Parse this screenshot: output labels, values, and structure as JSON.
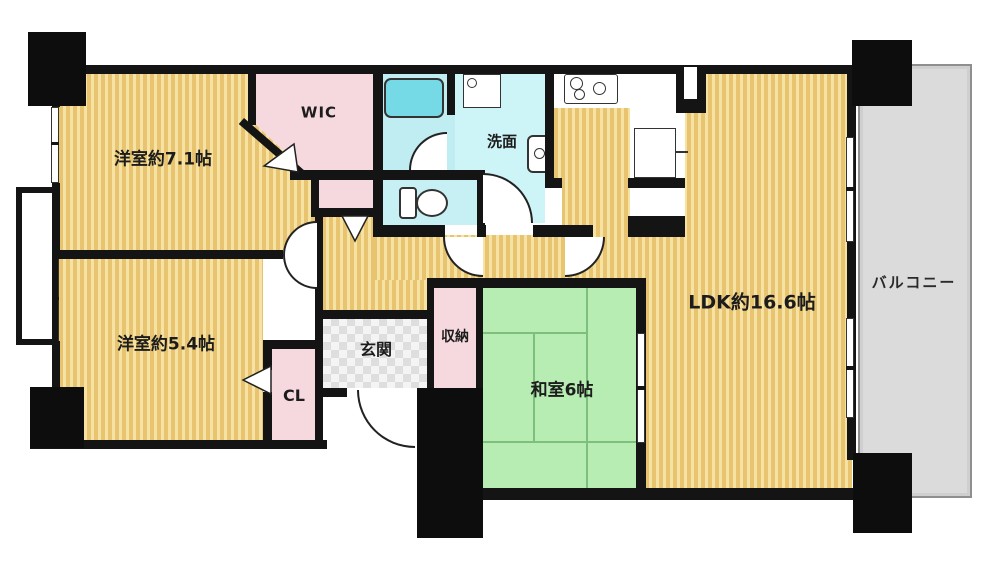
{
  "title": "Apartment floor plan",
  "rooms": {
    "bedroom1": {
      "label": "洋室約7.1帖"
    },
    "bedroom2": {
      "label": "洋室約5.4帖"
    },
    "ldk": {
      "label": "LDK約16.6帖"
    },
    "japanese_room": {
      "label": "和室6帖"
    },
    "wic": {
      "label": "WIC"
    },
    "closet": {
      "label": "CL"
    },
    "storage": {
      "label": "収納"
    },
    "entrance": {
      "label": "玄関"
    },
    "washroom": {
      "label": "洗面"
    },
    "balcony": {
      "label": "バルコニー"
    }
  },
  "fixtures": [
    "bathtub",
    "washing-machine",
    "washbasin",
    "toilet",
    "stove-3-burner",
    "refrigerator"
  ],
  "colors": {
    "wall": "#141414",
    "wood_floor": "#ecca75",
    "wood_stripe": "#f6e3a3",
    "tatami_green": "#b7ecb2",
    "tatami_line": "#7cc07c",
    "closet_pink": "#f6d9de",
    "bath_cyan": "#c0edf2",
    "washroom_cyan": "#cdf4f6",
    "bathtub_cyan": "#76d9e6",
    "balcony_gray": "#dbdbdb",
    "entrance_checker": "#dedede",
    "background": "#ffffff"
  }
}
